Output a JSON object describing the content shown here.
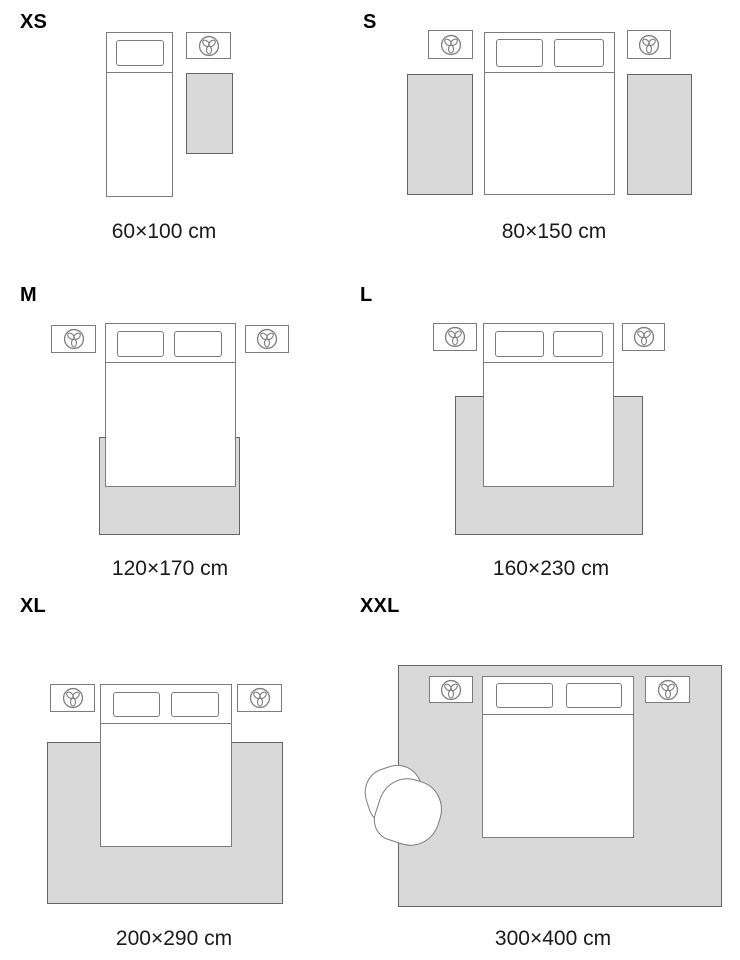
{
  "title": "Rug size guide",
  "colors": {
    "background": "#ffffff",
    "furniture_outline": "#7c7c7c",
    "rug_fill": "#d9d9d9",
    "rug_border": "#646464",
    "label_text": "#000000",
    "caption_text": "#1a1a1a"
  },
  "icons": {
    "nightstand_icon": "plant-top-view-icon"
  },
  "panels": [
    {
      "size_label": "XS",
      "dimensions": "60×100 cm"
    },
    {
      "size_label": "S",
      "dimensions": "80×150 cm"
    },
    {
      "size_label": "M",
      "dimensions": "120×170 cm"
    },
    {
      "size_label": "L",
      "dimensions": "160×230 cm"
    },
    {
      "size_label": "XL",
      "dimensions": "200×290 cm"
    },
    {
      "size_label": "XXL",
      "dimensions": "300×400 cm"
    }
  ]
}
